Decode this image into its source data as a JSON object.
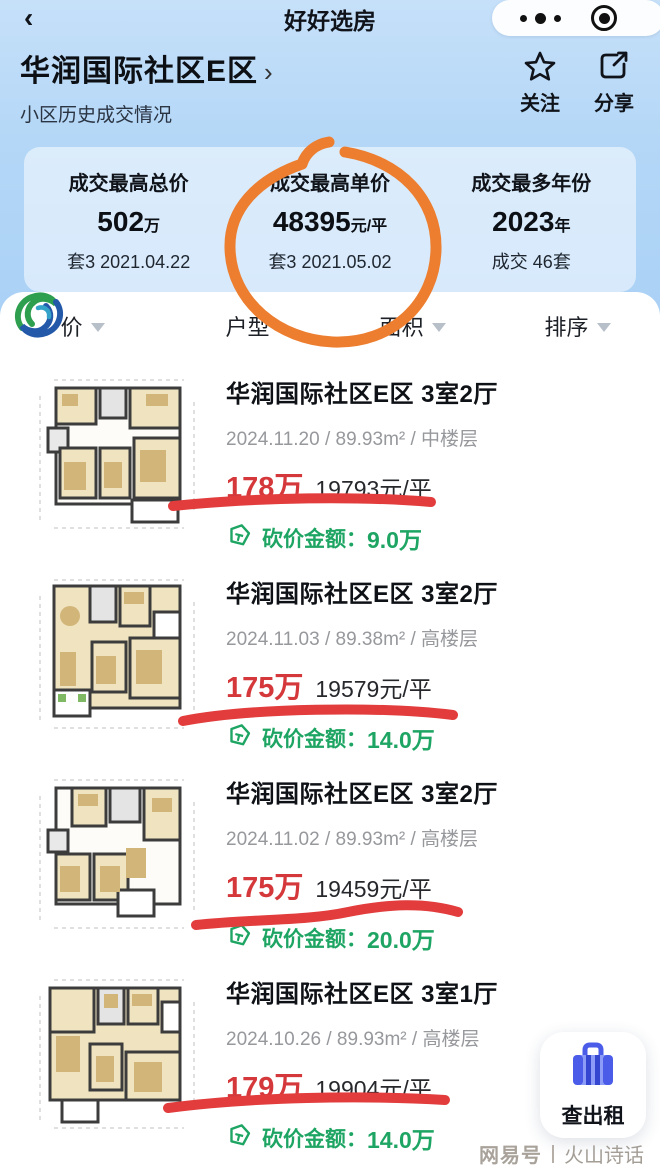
{
  "navbar": {
    "back_icon": "‹",
    "app_title": "好好选房"
  },
  "community": {
    "name": "华润国际社区E区",
    "chevron": "›",
    "subtitle": "小区历史成交情况",
    "follow_label": "关注",
    "share_label": "分享"
  },
  "stats": {
    "items": [
      {
        "label": "成交最高总价",
        "value": "502",
        "unit": "万",
        "meta": "套3 2021.04.22"
      },
      {
        "label": "成交最高单价",
        "value": "48395",
        "unit": "元/平",
        "meta": "套3 2021.05.02"
      },
      {
        "label": "成交最多年份",
        "value": "2023",
        "unit": "年",
        "meta": "成交 46套"
      }
    ],
    "annotation": "hand-drawn orange circle around 成交最高单价"
  },
  "filters": {
    "price": "价",
    "layout": "户型",
    "area": "面积",
    "sort": "排序"
  },
  "listings": [
    {
      "title": "华润国际社区E区 3室2厅",
      "info": "2024.11.20 / 89.93m² / 中楼层",
      "price": "178万",
      "unit_price": "19793元/平",
      "discount_label": "砍价金额：",
      "discount_value": "9.0万"
    },
    {
      "title": "华润国际社区E区 3室2厅",
      "info": "2024.11.03 / 89.38m² / 高楼层",
      "price": "175万",
      "unit_price": "19579元/平",
      "discount_label": "砍价金额：",
      "discount_value": "14.0万"
    },
    {
      "title": "华润国际社区E区 3室2厅",
      "info": "2024.11.02 / 89.93m² / 高楼层",
      "price": "175万",
      "unit_price": "19459元/平",
      "discount_label": "砍价金额：",
      "discount_value": "20.0万"
    },
    {
      "title": "华润国际社区E区 3室1厅",
      "info": "2024.10.26 / 89.93m² / 高楼层",
      "price": "179万",
      "unit_price": "19904元/平",
      "discount_label": "砍价金额：",
      "discount_value": "14.0万"
    }
  ],
  "floating_button": {
    "label": "查出租"
  },
  "footer": {
    "source": "网易号",
    "name": "火山诗话"
  },
  "watermarks": {
    "brand": "好好选房",
    "mini": "小程序"
  },
  "colors": {
    "price_red": "#d5383b",
    "underline_red": "#e23c3c",
    "discount_green": "#1ea563",
    "annotation_orange": "#ed7e2f",
    "button_blue": "#4a5ce8",
    "page_blue": "#a8d0f5"
  }
}
